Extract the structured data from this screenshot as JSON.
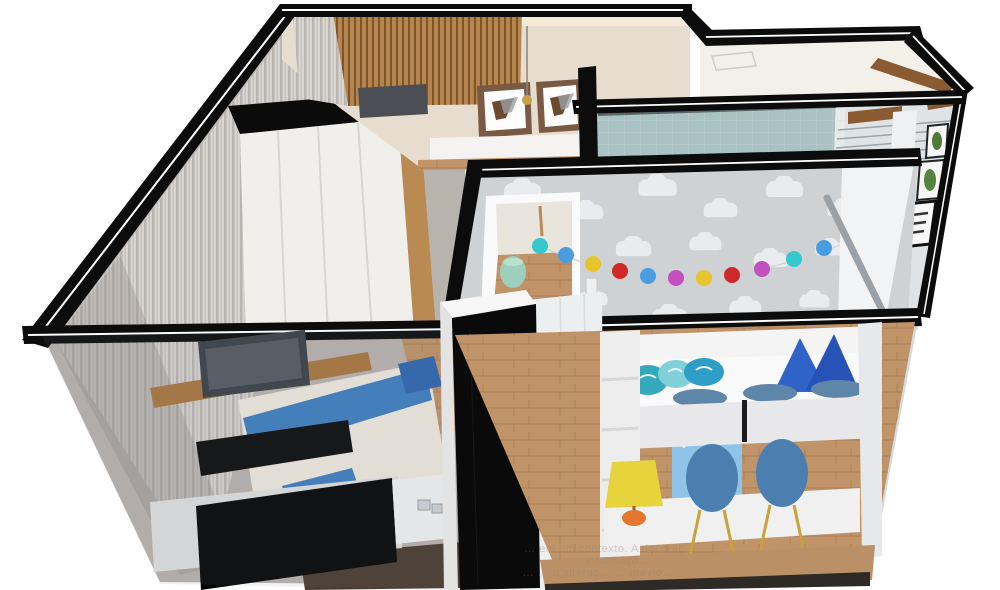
{
  "scene": {
    "type": "3d-floorplan-cutaway-render",
    "description": "Isometric dollhouse render of a two-bedroom apartment",
    "rooms": [
      {
        "name": "master-bedroom",
        "furniture": [
          "wardrobe",
          "double-bed",
          "desk-shelf",
          "laptop",
          "tv-panel",
          "tv",
          "tv-sideboard",
          "nightstand",
          "sheer-curtains"
        ]
      },
      {
        "name": "living-room",
        "furniture": [
          "wood-slat-tv-wall",
          "wall-tv",
          "framed-art-1",
          "framed-art-2",
          "pendant-lamp",
          "sideboard"
        ]
      },
      {
        "name": "bathroom",
        "furniture": [
          "blue-tile-wall",
          "white-tile-wall"
        ]
      },
      {
        "name": "kids-room",
        "furniture": [
          "cloud-wallpaper",
          "pompom-garland",
          "loft-bed",
          "pillows",
          "kids-chairs",
          "kids-desk",
          "table-lamp",
          "hexagon-shelves",
          "star-curtain"
        ]
      },
      {
        "name": "hallway",
        "furniture": [
          "mint-pouf",
          "wood-floor"
        ]
      },
      {
        "name": "office-balcony",
        "furniture": [
          "wood-shelves",
          "glass-railing",
          "plant-frames",
          "white-cabinet",
          "kitchen-column"
        ]
      }
    ]
  },
  "watermark": {
    "lines": [
      "… em um contexto. A decoraç…",
      "… informaçõ… …",
      "… … a alteraç… … prévio …"
    ]
  },
  "palette": {
    "wall_cut_black": "#0c0c0c",
    "wall_highlight": "#ffffff",
    "floor_wood": "#c09468",
    "floor_wood_dark": "#4a3c30",
    "living_beige": "#e6ddcf",
    "slat_wood": "#b5854f",
    "bathroom_tile_teal": "#a9c2c4",
    "bathroom_tile_white": "#e8ebec",
    "wallpaper_gray": "#ced2d5",
    "cloud_white": "#e9ebec",
    "bed_blue": "#3f7fc1",
    "pillow_teal": "#35a9bc",
    "pillow_royal_blue": "#2f63c8",
    "chair_blue": "#4a7fb0",
    "chair_leg_gold": "#c9a23c",
    "lamp_yellow": "#e7d33c",
    "lamp_base_orange": "#e4762e",
    "pouf_mint": "#9ecfbc",
    "shelf_brown": "#8a5a30",
    "garland_colors": [
      "#35c8cf",
      "#4a9de0",
      "#e6c42e",
      "#cf2828",
      "#4a9de0",
      "#c44fc0",
      "#e6c42e",
      "#cf2828",
      "#c44fc0",
      "#35c8cf",
      "#4a9de0"
    ],
    "hex_shelf_colors": [
      "#5aa7d8",
      "#e6c829",
      "#d8a0b0",
      "#9b59a8",
      "#5aa7d8",
      "#e6c829",
      "#d8a0b0"
    ]
  }
}
